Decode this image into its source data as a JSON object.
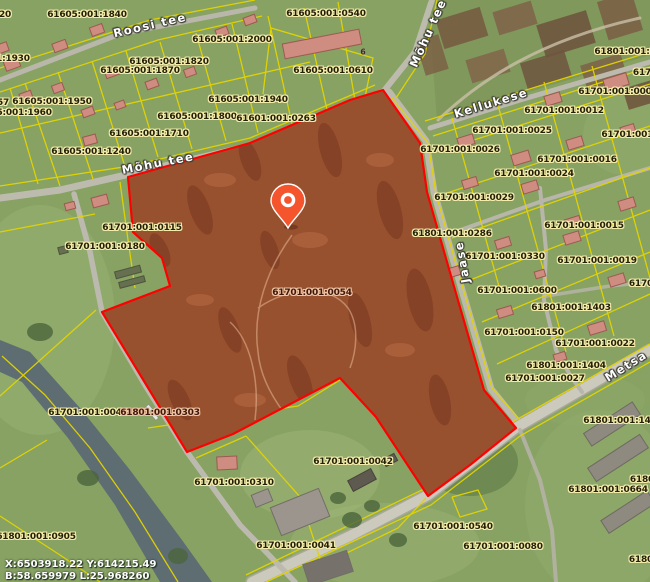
{
  "app": {
    "type": "cadastral-map-viewer"
  },
  "selected_parcel": {
    "id": "61701:001:0054"
  },
  "coordinates_readout": {
    "line1": "X:6503918.22 Y:614215.49",
    "line2": "B:58.659979 L:25.968260"
  },
  "parcel_labels": [
    {
      "text": "20",
      "x": 5,
      "y": 15
    },
    {
      "text": "61605:001:1840",
      "x": 87,
      "y": 15
    },
    {
      "text": "61605:001:2000",
      "x": 232,
      "y": 40
    },
    {
      "text": "61605:001:1930",
      "x": -10,
      "y": 59
    },
    {
      "text": "61605:001:1820",
      "x": 169,
      "y": 62
    },
    {
      "text": "61605:001:1870",
      "x": 140,
      "y": 71
    },
    {
      "text": "57",
      "x": 3,
      "y": 103
    },
    {
      "text": "61605:001:1950",
      "x": 52,
      "y": 102
    },
    {
      "text": "61605:001:1960",
      "x": 12,
      "y": 113
    },
    {
      "text": "61605:001:1940",
      "x": 248,
      "y": 100
    },
    {
      "text": "61605:001:1800",
      "x": 197,
      "y": 117
    },
    {
      "text": "61601:001:0263",
      "x": 276,
      "y": 119
    },
    {
      "text": "61605:001:1710",
      "x": 149,
      "y": 134
    },
    {
      "text": "61605:001:1240",
      "x": 91,
      "y": 152
    },
    {
      "text": "61605:001:0540",
      "x": 326,
      "y": 14
    },
    {
      "text": "61605:001:0610",
      "x": 333,
      "y": 71
    },
    {
      "text": "61701:001:0115",
      "x": 142,
      "y": 228
    },
    {
      "text": "61701:001:0180",
      "x": 105,
      "y": 247
    },
    {
      "text": "61701:001:0054",
      "x": 312,
      "y": 293,
      "on_red": true
    },
    {
      "text": "61801:001:0286",
      "x": 452,
      "y": 234
    },
    {
      "text": "61701:001:0026",
      "x": 460,
      "y": 150
    },
    {
      "text": "61701:001:0025",
      "x": 512,
      "y": 131
    },
    {
      "text": "61701:001:0012",
      "x": 564,
      "y": 111
    },
    {
      "text": "61701:001:0009",
      "x": 618,
      "y": 92
    },
    {
      "text": "61801:001:0",
      "x": 625,
      "y": 52
    },
    {
      "text": "617",
      "x": 642,
      "y": 73
    },
    {
      "text": "61701:001:0",
      "x": 632,
      "y": 135
    },
    {
      "text": "61701:001:0016",
      "x": 577,
      "y": 160
    },
    {
      "text": "61701:001:0024",
      "x": 534,
      "y": 174
    },
    {
      "text": "61701:001:0029",
      "x": 474,
      "y": 198
    },
    {
      "text": "61701:001:0015",
      "x": 584,
      "y": 226
    },
    {
      "text": "61701:001:0330",
      "x": 505,
      "y": 257
    },
    {
      "text": "61701:001:0019",
      "x": 597,
      "y": 261
    },
    {
      "text": "61701:001:0600",
      "x": 517,
      "y": 291
    },
    {
      "text": "61801:001:1403",
      "x": 571,
      "y": 308
    },
    {
      "text": "61701:001:0150",
      "x": 524,
      "y": 333
    },
    {
      "text": "61701:001:0022",
      "x": 595,
      "y": 344
    },
    {
      "text": "6170",
      "x": 641,
      "y": 284
    },
    {
      "text": "61801:001:1404",
      "x": 566,
      "y": 366
    },
    {
      "text": "61701:001:0027",
      "x": 545,
      "y": 379
    },
    {
      "text": "61701:001:0048",
      "x": 88,
      "y": 413
    },
    {
      "text": "61801:001:0303",
      "x": 160,
      "y": 413,
      "on_red": true
    },
    {
      "text": "61801:001:0905",
      "x": 36,
      "y": 537
    },
    {
      "text": "61701:001:0310",
      "x": 234,
      "y": 483
    },
    {
      "text": "61701:001:0042",
      "x": 353,
      "y": 462
    },
    {
      "text": "61701:001:0041",
      "x": 296,
      "y": 546
    },
    {
      "text": "61701:001:0540",
      "x": 453,
      "y": 527
    },
    {
      "text": "61701:001:0080",
      "x": 503,
      "y": 547
    },
    {
      "text": "61801:001:142",
      "x": 620,
      "y": 421
    },
    {
      "text": "6180",
      "x": 642,
      "y": 480
    },
    {
      "text": "61801:001:0664",
      "x": 608,
      "y": 490
    },
    {
      "text": "61801",
      "x": 644,
      "y": 560
    }
  ],
  "street_labels": [
    {
      "text": "Roosi tee",
      "x": 150,
      "y": 25,
      "rot": -13
    },
    {
      "text": "Mõhu tee",
      "x": 428,
      "y": 33,
      "rot": -66
    },
    {
      "text": "Mõhu tee",
      "x": 158,
      "y": 163,
      "rot": -11
    },
    {
      "text": "Kellukese",
      "x": 491,
      "y": 103,
      "rot": -17
    },
    {
      "text": "Jaase",
      "x": 462,
      "y": 262,
      "rot": -100
    },
    {
      "text": "Metsa",
      "x": 626,
      "y": 366,
      "rot": -32
    }
  ],
  "building_labels": [
    {
      "text": "6",
      "x": 363,
      "y": 52
    }
  ],
  "colors": {
    "field_green": "#87a263",
    "forest_green": "#5a6a42",
    "selection_outline": "#ff0000",
    "selection_fill": "#d13c1c",
    "cadastral_yellow": "#e3d400",
    "road_gray": "#bcbaae",
    "river_gray_blue": "#5d6d72",
    "pin_orange": "#f4552c",
    "parcel_label_text": "#241f07",
    "parcel_label_halo": "#f3ecab",
    "street_label_text": "#ffffff"
  }
}
